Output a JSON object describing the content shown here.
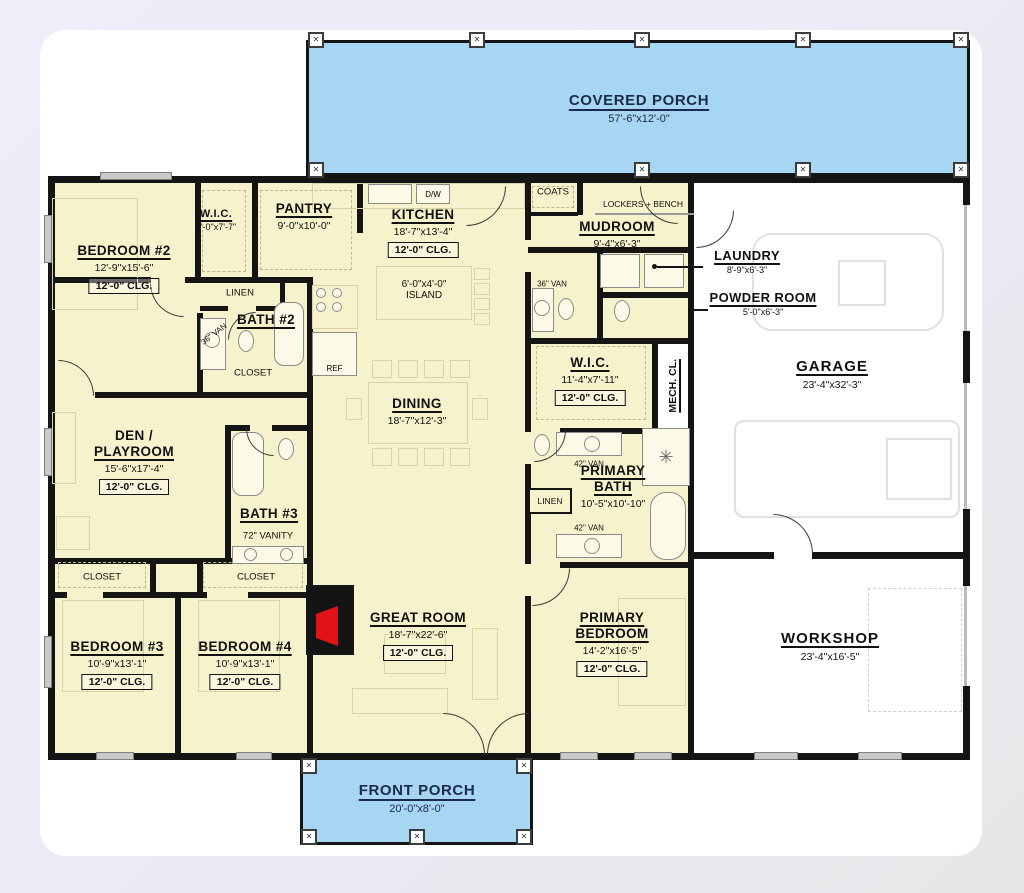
{
  "plan_title": "Barndominium Floor Plan",
  "porches": {
    "covered": {
      "name": "COVERED PORCH",
      "dims": "57'-6\"x12'-0\""
    },
    "front": {
      "name": "FRONT PORCH",
      "dims": "20'-0\"x8'-0\""
    }
  },
  "rooms": {
    "bedroom2": {
      "name": "BEDROOM #2",
      "dims": "12'-9\"x15'-6\"",
      "clg": "12'-0\" CLG."
    },
    "wic1": {
      "name": "W.I.C.",
      "dims": "4'-0\"x7'-7\""
    },
    "pantry": {
      "name": "PANTRY",
      "dims": "9'-0\"x10'-0\""
    },
    "kitchen": {
      "name": "KITCHEN",
      "dims": "18'-7\"x13'-4\"",
      "clg": "12'-0\" CLG."
    },
    "island": {
      "dims": "6'-0\"x4'-0\"",
      "name": "ISLAND"
    },
    "mudroom": {
      "name": "MUDROOM",
      "dims": "9'-4\"x6'-3\""
    },
    "laundry": {
      "name": "LAUNDRY",
      "dims": "8'-9\"x6'-3\""
    },
    "powder": {
      "name": "POWDER ROOM",
      "dims": "5'-0\"x6'-3\""
    },
    "garage": {
      "name": "GARAGE",
      "dims": "23'-4\"x32'-3\""
    },
    "bath2": {
      "name": "BATH #2"
    },
    "dining": {
      "name": "DINING",
      "dims": "18'-7\"x12'-3\""
    },
    "wic2": {
      "name": "W.I.C.",
      "dims": "11'-4\"x7'-11\"",
      "clg": "12'-0\" CLG."
    },
    "mech": {
      "name": "MECH. CL."
    },
    "den": {
      "name1": "DEN /",
      "name2": "PLAYROOM",
      "dims": "15'-6\"x17'-4\"",
      "clg": "12'-0\" CLG."
    },
    "bath3": {
      "name": "BATH #3",
      "vanity": "72\" VANITY"
    },
    "primary_bath": {
      "name": "PRIMARY\nBATH",
      "dims": "10'-5\"x10'-10\""
    },
    "bedroom3": {
      "name": "BEDROOM #3",
      "dims": "10'-9\"x13'-1\"",
      "clg": "12'-0\" CLG."
    },
    "bedroom4": {
      "name": "BEDROOM #4",
      "dims": "10'-9\"x13'-1\"",
      "clg": "12'-0\" CLG."
    },
    "great_room": {
      "name": "GREAT ROOM",
      "dims": "18'-7\"x22'-6\"",
      "clg": "12'-0\" CLG."
    },
    "primary_bedroom": {
      "name": "PRIMARY\nBEDROOM",
      "dims": "14'-2\"x16'-5\"",
      "clg": "12'-0\" CLG."
    },
    "workshop": {
      "name": "WORKSHOP",
      "dims": "23'-4\"x16'-5\""
    }
  },
  "fixtures": {
    "coats": "COATS",
    "lockers": "LOCKERS + BENCH",
    "linen": "LINEN",
    "closet": "CLOSET",
    "ref": "REF",
    "dw": "D/W",
    "van36": "36\" VAN",
    "van42": "42\" VAN"
  },
  "icons": {
    "post": "✕",
    "shower": "✳"
  },
  "colors": {
    "porch_fill": "#a7d6f2",
    "interior_fill": "#f6f2cc",
    "wall": "#141414",
    "fireplace_red": "#e01317",
    "porch_text": "#1b2a4a",
    "background": "#edebf7",
    "card": "#ffffff"
  }
}
